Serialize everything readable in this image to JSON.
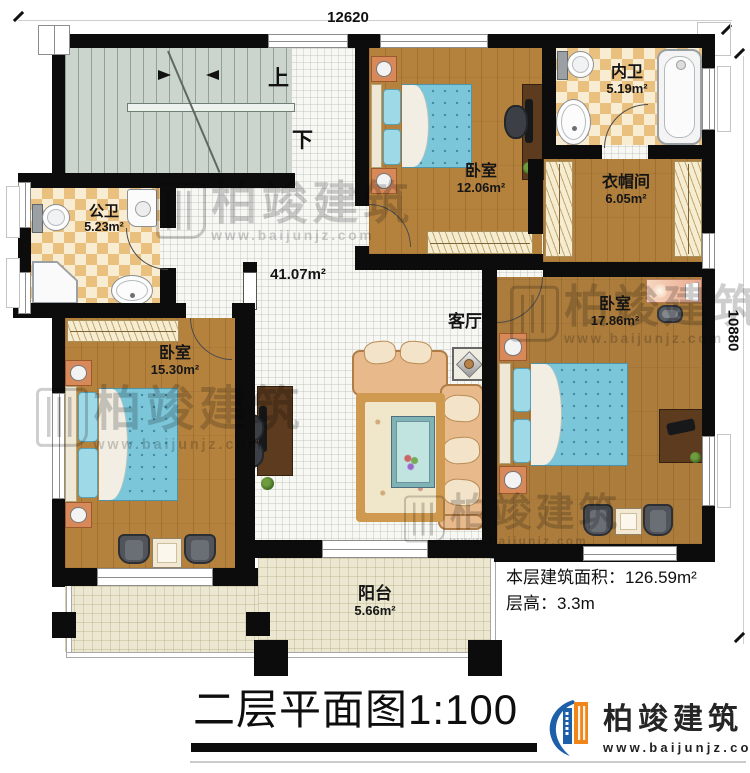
{
  "plan": {
    "dim_top": "12620",
    "dim_right": "10880",
    "stair_up": "上",
    "stair_down": "下",
    "hall_area": "41.07m²",
    "living_label": "客厅",
    "rooms": {
      "public_bath": {
        "name": "公卫",
        "area": "5.23m²"
      },
      "inner_bath": {
        "name": "内卫",
        "area": "5.19m²"
      },
      "cloakroom": {
        "name": "衣帽间",
        "area": "6.05m²"
      },
      "bedroom_top": {
        "name": "卧室",
        "area": "12.06m²"
      },
      "bedroom_left": {
        "name": "卧室",
        "area": "15.30m²"
      },
      "bedroom_right": {
        "name": "卧室",
        "area": "17.86m²"
      },
      "balcony": {
        "name": "阳台",
        "area": "5.66m²"
      }
    }
  },
  "info": {
    "floor_area_label": "本层建筑面积：",
    "floor_area_value": "126.59m²",
    "floor_height_label": "层高：",
    "floor_height_value": "3.3m"
  },
  "title": {
    "name": "二层平面图",
    "scale": "1:100"
  },
  "brand": {
    "name": "柏竣建筑",
    "website": "www.baijunjz.com"
  },
  "watermark": {
    "name": "柏竣建筑",
    "website": "www.baijunjz.com"
  },
  "colors": {
    "wall": "#0c0c0c",
    "wood_floor": "#b5823e",
    "bath_tile": "#eac07e",
    "hall_tile": "#f7f7f4",
    "stair": "#cbd4cd",
    "balcony_tile": "#ece7d1",
    "bed_blue": "#7cc6da",
    "sofa_tan": "#e7b98b",
    "brand_blue": "#1d5fa9",
    "brand_orange": "#f08519"
  }
}
